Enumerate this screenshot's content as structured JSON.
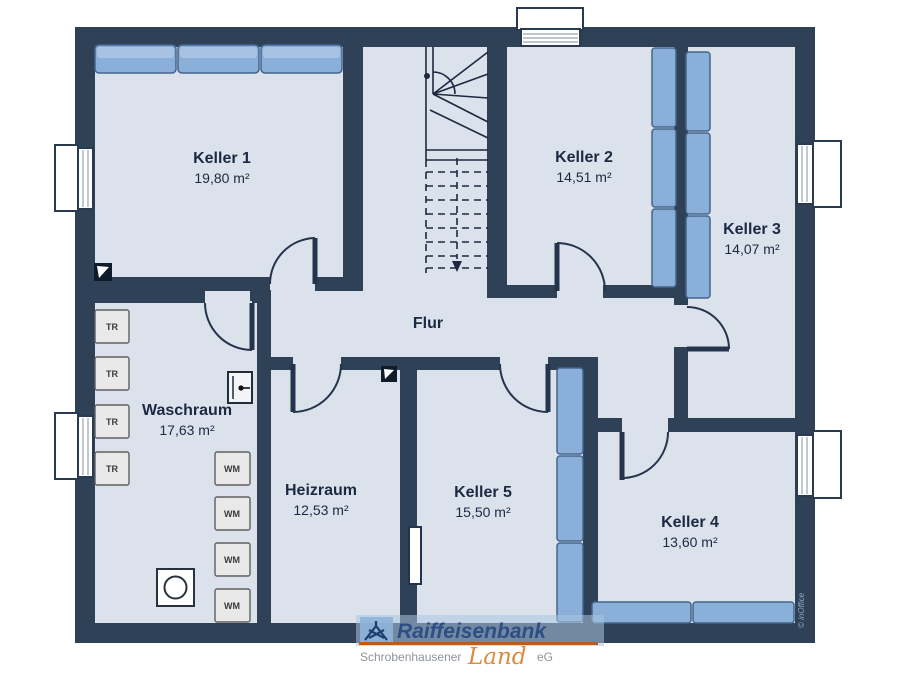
{
  "plan": {
    "rooms": {
      "keller1": {
        "name": "Keller 1",
        "area": "19,80 m²"
      },
      "keller2": {
        "name": "Keller 2",
        "area": "14,51 m²"
      },
      "keller3": {
        "name": "Keller 3",
        "area": "14,07 m²"
      },
      "keller4": {
        "name": "Keller 4",
        "area": "13,60 m²"
      },
      "keller5": {
        "name": "Keller 5",
        "area": "15,50 m²"
      },
      "waschraum": {
        "name": "Waschraum",
        "area": "17,63 m²"
      },
      "heizraum": {
        "name": "Heizraum",
        "area": "12,53 m²"
      },
      "flur": {
        "name": "Flur"
      }
    },
    "fixtures": {
      "dryer_label": "TR",
      "washer_label": "WM"
    },
    "colors": {
      "wall": "#2f4156",
      "floor": "#dbe2ec",
      "furniture": "#8ab0da",
      "label_text": "#1b2a42"
    }
  },
  "watermarks": {
    "bank_name": "Raiffeisenbank",
    "bank_sub_left": "Schrobenhausener",
    "bank_sub_script": "Land",
    "bank_sub_right": "eG",
    "bank_colors": {
      "name_blue": "#2d4e86",
      "rule_orange": "#b85c20",
      "script_orange": "#dc8a3f"
    },
    "software": "© inOffice"
  }
}
